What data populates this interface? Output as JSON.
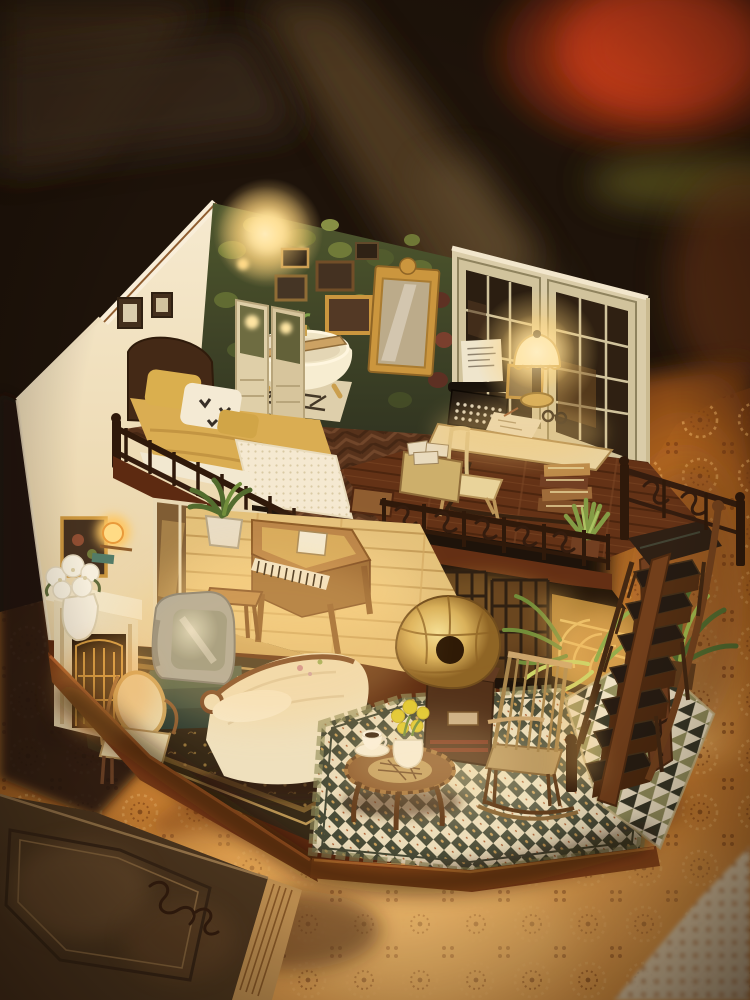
{
  "meta": {
    "type": "photograph",
    "subject": "DIY miniature dollhouse diorama (two-story loft apartment) standing on an orange crocheted lace tablecloth, warm interior lights on, dark blurred background with red glow",
    "width_px": 750,
    "height_px": 1000
  },
  "palette": {
    "bg_dark": "#120c08",
    "beam_brown": "#4a3722",
    "glow_red": "#e04a1e",
    "olive_streak": "#5d5c24",
    "cloth_orange": "#d98b38",
    "cloth_highlight": "#f6c071",
    "cloth_shadow": "#5f2c0d",
    "wall_cream": "#f2e8d0",
    "wall_green": "#3c4a28",
    "window_frame": "#cfc6a2",
    "pane_dark": "#20180f",
    "wood_dark": "#2a1810",
    "wood_mid": "#5f2f18",
    "wood_red": "#7a3a16",
    "floor_light": "#e3c37e",
    "herringbone": "#4e2d1a",
    "bedding_yellow": "#d9ae54",
    "linen_white": "#f5eeda",
    "tub_white": "#f7f2da",
    "lamp_glow": "#ffe9a8",
    "brass_gold": "#d9b45e",
    "mirror_gold": "#c9963f",
    "tile_cream": "#e9dfc0",
    "tile_green": "#3e4636",
    "tile_olive": "#8f8f5f",
    "rug_dark": "#2e2416",
    "rug_gold": "#b08c46",
    "tv_gray": "#a0a6a6",
    "sofa_cream": "#efe4c4",
    "plant_green": "#7a9a44",
    "flower_yellow": "#e0cc30",
    "flower_white": "#f7f4e6",
    "book_leather": "#46331f",
    "lace_white": "#e9ddc0"
  },
  "scene": {
    "background": [
      "blurred-wood-beams",
      "red-lamp-glow-top-right",
      "olive-green-streak"
    ],
    "upper_floor": {
      "bedroom": [
        "foliage-accent-wall",
        "wall-lamp-glow",
        "gallery-picture-frames",
        "gold-ornate-mirror",
        "clawfoot-bathtub",
        "bath-caddy-with-book-and-plant",
        "folding-screen-divider",
        "wooden-bed",
        "yellow-bedding",
        "butterfly-print-pillow",
        "crochet-throw",
        "two-wall-frames"
      ],
      "study": [
        "grid-windows",
        "vintage-typewriter-with-paper",
        "framed-photo",
        "fringed-table-lamp-lit",
        "reading-glasses",
        "scattered-papers",
        "writing-desk",
        "wooden-chair",
        "letter-box",
        "stack-of-old-books",
        "aloe-plant",
        "wrought-iron-balcony-railing"
      ]
    },
    "lower_floor": {
      "living_room": [
        "fireplace-with-screen",
        "framed-art",
        "amber-ball-lamp",
        "white-hydrangea-pot",
        "crt-television-on-green-books",
        "upholstered-side-chair",
        "cream-damask-sofa",
        "ornate-dark-rug",
        "grand-piano-on-light-platform",
        "piano-stool",
        "potted-plant",
        "mirror-panel-wall",
        "black-marble-column",
        "leaning-floral-painting",
        "lattice-glass-doors"
      ],
      "parlor": [
        "brass-gramophone-on-cabinet",
        "rocking-chair",
        "round-coffee-table",
        "coffee-cup-and-saucer",
        "vase-of-yellow-flowers",
        "checkerboard-tile-floor",
        "triangle-mosaic-walkway",
        "ferns-and-palm",
        "staircase-with-landing",
        "iron-scroll-railings"
      ]
    },
    "foreground": [
      "orange-crochet-tablecloth",
      "antique-leather-book-bottom-left",
      "white-lace-doily-corner"
    ]
  }
}
